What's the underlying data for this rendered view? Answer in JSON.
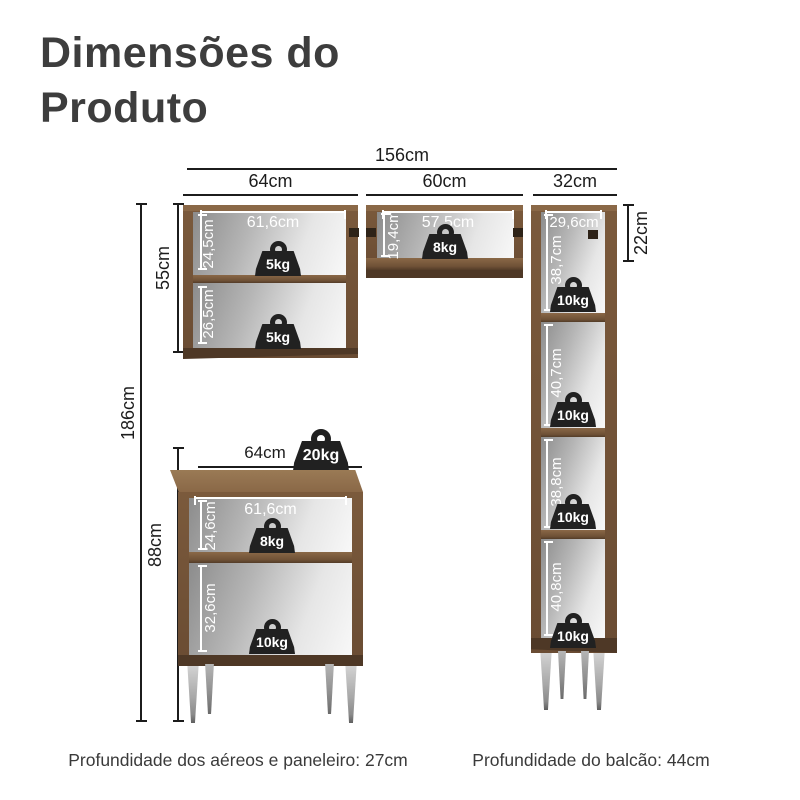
{
  "title": {
    "line1": "Dimensões do",
    "line2": "Produto"
  },
  "overall_dimensions": {
    "total_width": "156cm",
    "left_section_width": "64cm",
    "middle_section_width": "60cm",
    "right_section_width": "32cm",
    "total_height": "186cm",
    "upper_cabinet_height": "55cm",
    "base_cabinet_height": "88cm",
    "top_right_section_height": "22cm"
  },
  "upper_left_cabinet": {
    "inner_width": "61,6cm",
    "shelf1_height": "24,5cm",
    "shelf1_capacity": "5kg",
    "shelf2_height": "26,5cm",
    "shelf2_capacity": "5kg"
  },
  "upper_middle_cabinet": {
    "inner_width": "57,5cm",
    "inner_height": "19,4cm",
    "capacity": "8kg"
  },
  "tall_cabinet": {
    "inner_width": "29,6cm",
    "compartments": [
      {
        "height": "38,7cm",
        "capacity": "10kg"
      },
      {
        "height": "40,7cm",
        "capacity": "10kg"
      },
      {
        "height": "38,8cm",
        "capacity": "10kg"
      },
      {
        "height": "40,8cm",
        "capacity": "10kg"
      }
    ]
  },
  "base_cabinet": {
    "top_width": "64cm",
    "top_capacity": "20kg",
    "inner_width": "61,6cm",
    "shelf1_height": "24,6cm",
    "shelf1_capacity": "8kg",
    "shelf2_height": "32,6cm",
    "shelf2_capacity": "10kg"
  },
  "footer": {
    "left": "Profundidade dos aéreos e paneleiro: 27cm",
    "right": "Profundidade do balcão: 44cm"
  },
  "colors": {
    "wood": "#6a4c33",
    "wood_light": "#8a6847",
    "wood_dark": "#4e3826",
    "dimension_text": "#1c1c1c",
    "weight_badge": "#212121",
    "leg_silver": "#a8a8a8"
  }
}
